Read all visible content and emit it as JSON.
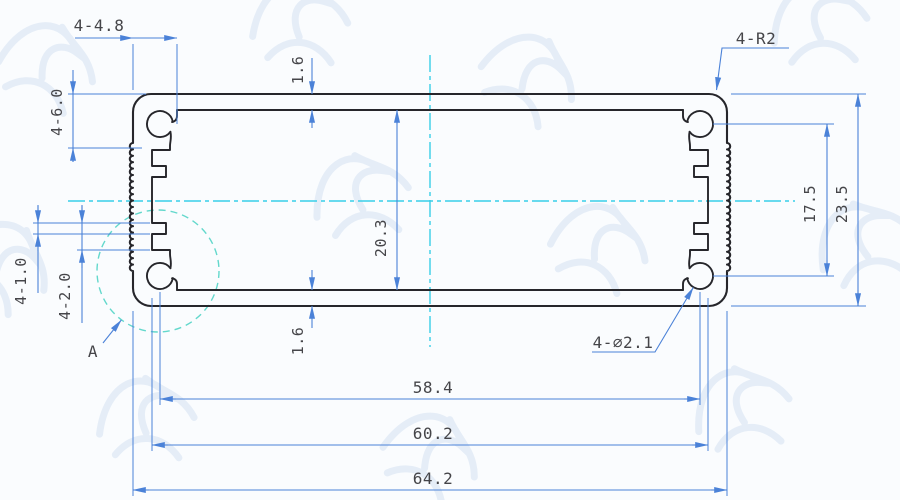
{
  "drawing": {
    "title_hint": "aluminium-extrusion-profile-cross-section",
    "colors": {
      "background": "#fafcfe",
      "profile": "#26262b",
      "dimension": "#4b82d8",
      "centerline": "#38cfe8",
      "detail": "#63d8cc",
      "text": "#454549",
      "watermark": "#ccdcf0"
    },
    "dimensions": {
      "top_slot_width": "4-4.8",
      "corner_zone_height": "4-6.0",
      "wall_top": "1.6",
      "corner_radius": "4-R2",
      "hole_pitch_v": "17.5",
      "outer_height": "23.5",
      "inner_height": "20.3",
      "rib_small": "4-1.0",
      "rib_large": "4-2.0",
      "wall_bottom": "1.6",
      "hole_dia": "4-∅2.1",
      "detail_label": "A",
      "hole_pitch_h": "58.4",
      "slot_span": "60.2",
      "outer_width": "64.2"
    }
  }
}
